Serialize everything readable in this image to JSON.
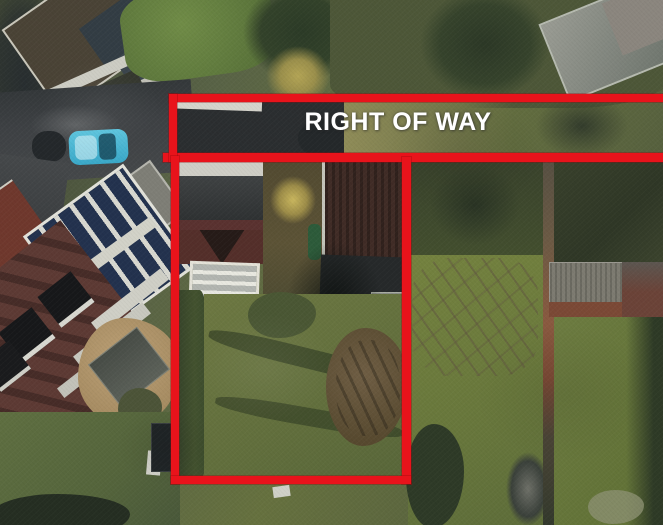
{
  "annotation": {
    "label": "RIGHT OF WAY",
    "line_color": "#e8131b",
    "label_color": "#ffffff"
  },
  "scene": {
    "description": "aerial photograph of suburban houses and back gardens",
    "features": [
      "road",
      "parked-teal-car",
      "terraced-house-roofs",
      "house-with-dormer-windows",
      "conservatory-glass-roof",
      "garden-lawns",
      "brick-garden-wall",
      "outbuildings",
      "trees-and-hedges"
    ]
  }
}
